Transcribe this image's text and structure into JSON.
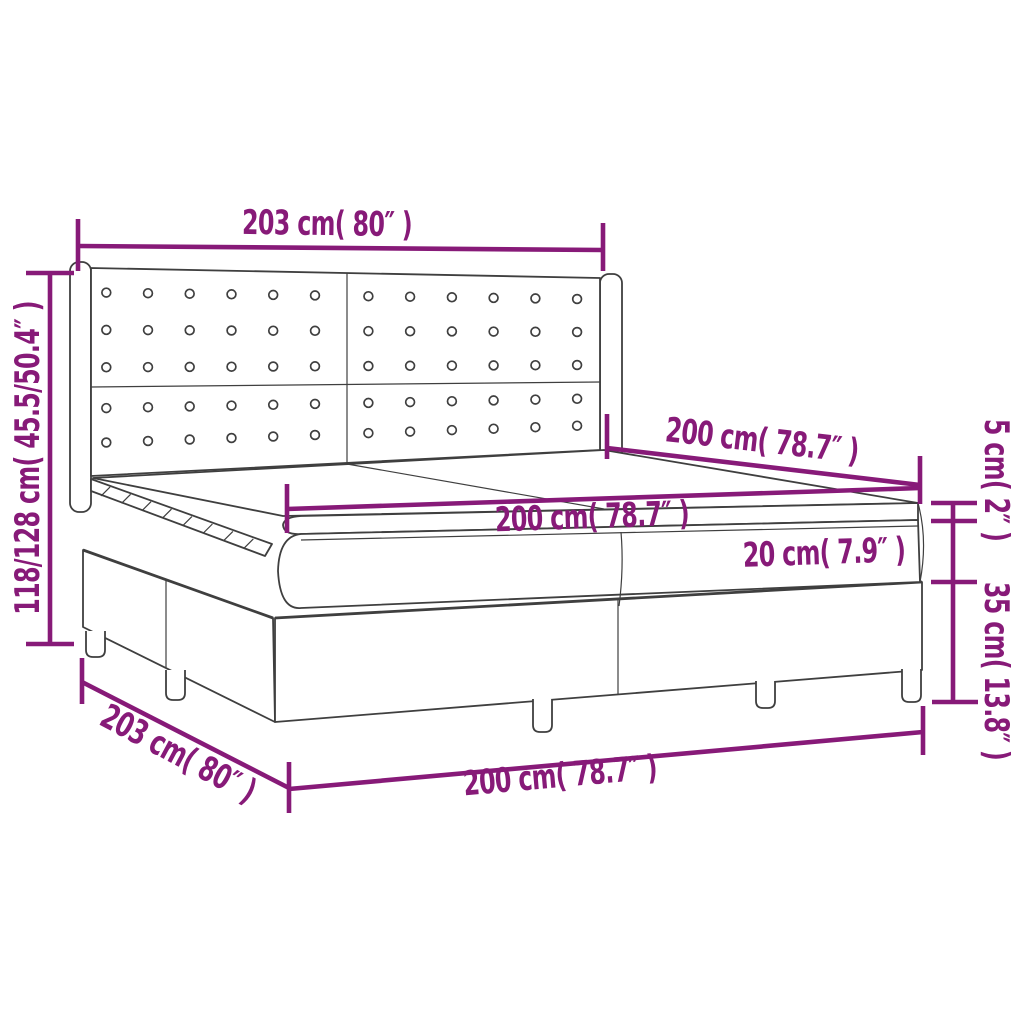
{
  "title": "Box spring bed with headboard and mattress — dimension diagram",
  "colors": {
    "dimension_annotation": "#871a78",
    "drawing_outline": "#3f3f3f",
    "background": "#ffffff"
  },
  "dimensions": {
    "headboard_width": {
      "cm": "203",
      "inch": "80",
      "label": "203 cm( 80″ )"
    },
    "height_range": {
      "cm": "118/128",
      "inch": "45.5/50.4",
      "label": "118/128 cm( 45.5/50.4″ )"
    },
    "inner_length": {
      "cm": "200",
      "inch": "78.7",
      "label": "200 cm( 78.7″ )"
    },
    "mattress_length": {
      "cm": "200",
      "inch": "78.7",
      "label": "200 cm( 78.7″ )"
    },
    "mattress_height": {
      "cm": "20",
      "inch": "7.9",
      "label": "20 cm( 7.9″ )"
    },
    "topper_height": {
      "cm": "5",
      "inch": "2",
      "label": "5 cm( 2″ )"
    },
    "base_height": {
      "cm": "35",
      "inch": "13.8",
      "label": "35 cm( 13.8″ )"
    },
    "base_width": {
      "cm": "203",
      "inch": "80",
      "label": "203 cm( 80″ )"
    },
    "base_length": {
      "cm": "200",
      "inch": "78.7",
      "label": "200 cm( 78.7″ )"
    }
  },
  "headboard": {
    "button_cols_per_half": 6,
    "button_rows_top": 3,
    "button_rows_bottom": 2
  },
  "slat_dashes": 8
}
